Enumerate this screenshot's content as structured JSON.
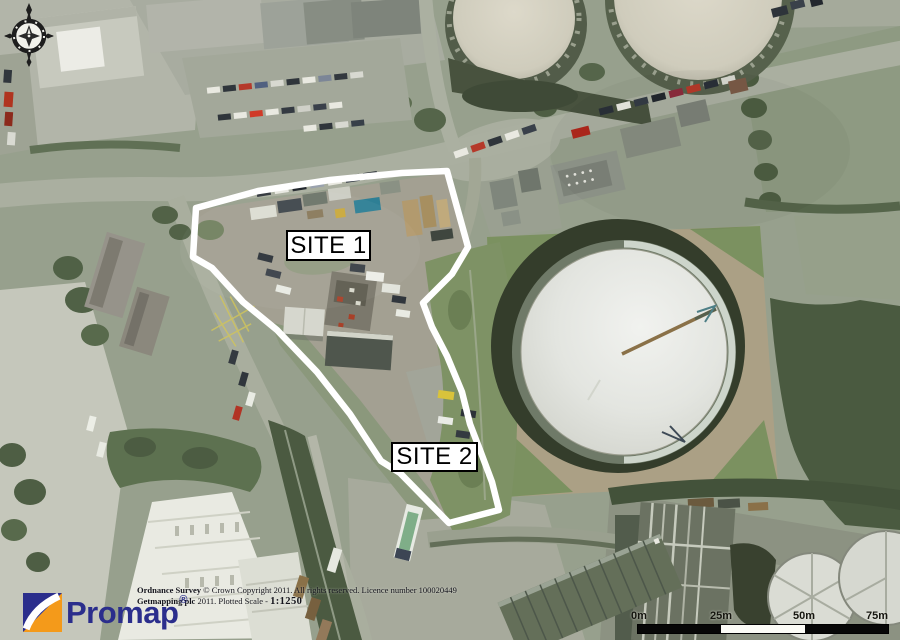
{
  "map": {
    "type": "aerial-site-plan",
    "boundary_color": "#ffffff",
    "sites": [
      {
        "label": "SITE 1"
      },
      {
        "label": "SITE 2"
      }
    ]
  },
  "compass": {
    "icon": "compass-rose-icon"
  },
  "footer": {
    "logo": {
      "name": "Promap",
      "registered_mark": "®",
      "brand_blue": "#2b2e8c",
      "brand_orange": "#f49a1a"
    },
    "attribution": {
      "line1_bold": "Ordnance Survey",
      "line1_rest": " © Crown Copyright 2011. All rights reserved. Licence number 100020449",
      "line2_bold": "Getmapping plc",
      "line2_rest": " 2011. Plotted Scale - ",
      "plotted_scale": "1:1250"
    }
  },
  "scale_bar": {
    "labels": [
      "0m",
      "25m",
      "50m",
      "75m"
    ],
    "segment_colors": [
      "#000000",
      "#ffffff",
      "#000000"
    ]
  }
}
